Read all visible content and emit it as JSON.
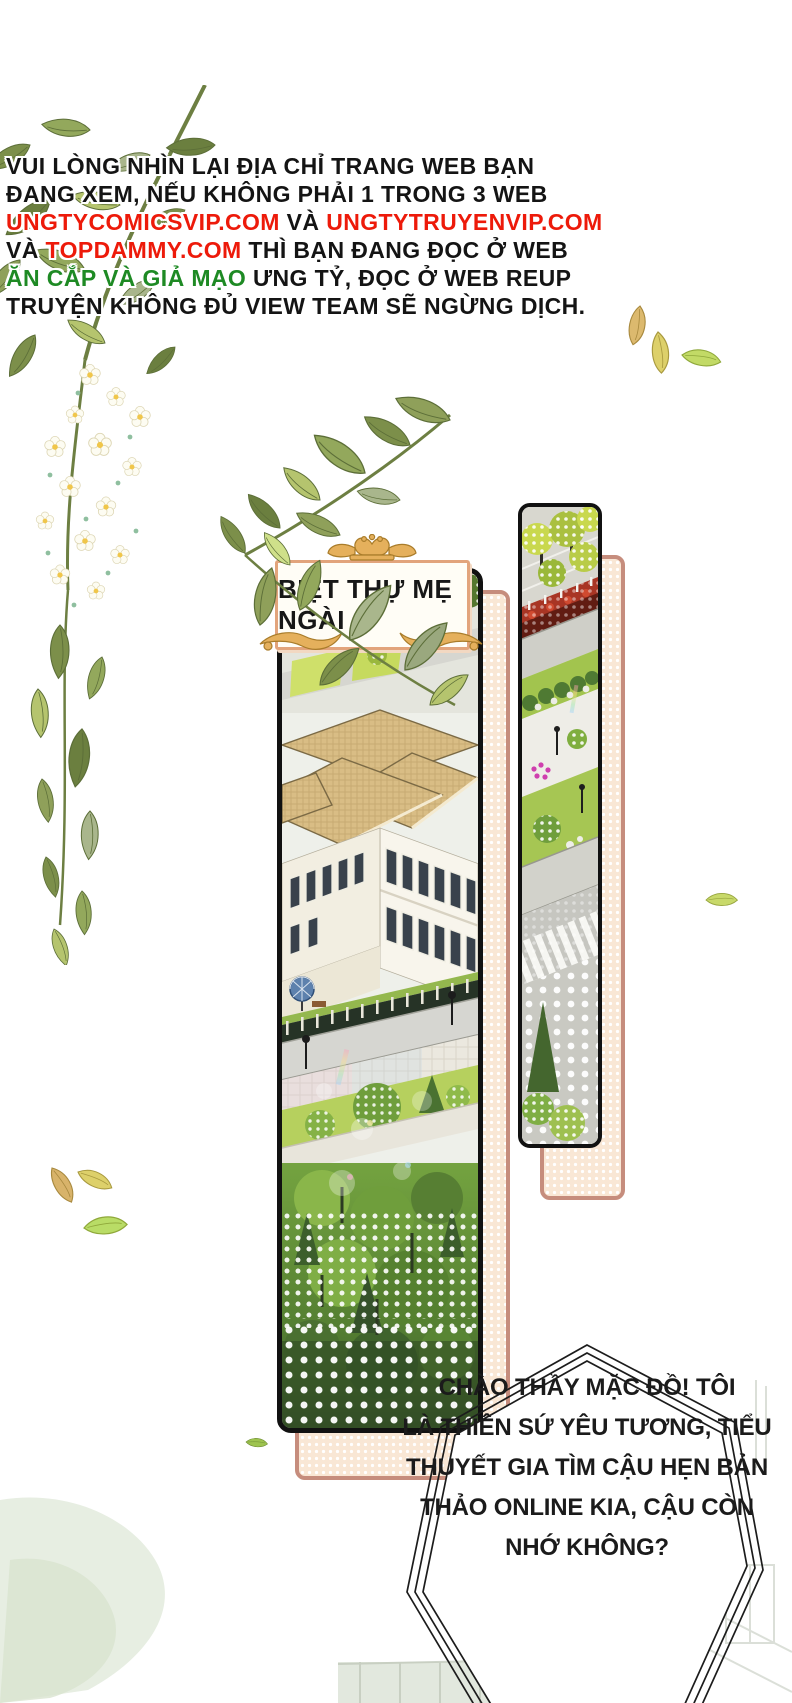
{
  "page": {
    "width": 792,
    "height": 1703,
    "background": "#ffffff"
  },
  "warning": {
    "colors": {
      "black": "#141414",
      "red": "#ed1a0a",
      "green": "#1e8a24"
    },
    "lines": [
      {
        "segments": [
          {
            "color": "black",
            "text": "VUI LÒNG NHÌN LẠI ĐỊA CHỈ TRANG WEB BẠN"
          }
        ]
      },
      {
        "segments": [
          {
            "color": "black",
            "text": "ĐANG XEM, NẾU KHÔNG PHẢI 1 TRONG 3 WEB"
          }
        ]
      },
      {
        "segments": [
          {
            "color": "red",
            "text": "UNGTYCOMICSVIP.COM"
          },
          {
            "color": "black",
            "text": " VÀ "
          },
          {
            "color": "red",
            "text": "UNGTYTRUYENVIP.COM"
          }
        ]
      },
      {
        "segments": [
          {
            "color": "black",
            "text": "VÀ "
          },
          {
            "color": "red",
            "text": "TOPDAMMY.COM"
          },
          {
            "color": "black",
            "text": " THÌ BẠN ĐANG ĐỌC Ở WEB"
          }
        ]
      },
      {
        "segments": [
          {
            "color": "green",
            "text": "ĂN CẮP VÀ GIẢ MẠO"
          },
          {
            "color": "black",
            "text": " ƯNG TỶ, ĐỌC Ở WEB REUP"
          }
        ]
      },
      {
        "segments": [
          {
            "color": "black",
            "text": "TRUYỆN KHÔNG ĐỦ VIEW TEAM SẼ NGỪNG DỊCH."
          }
        ]
      }
    ]
  },
  "location_label": {
    "text": "BIỆT THỰ MẸ NGÀI",
    "frame_color": "#e2a47c",
    "ornament_gold": "#e5b05c"
  },
  "speech_bubble": {
    "lines": [
      "CHÀO THẦY MẶC ĐỒ! TÔI",
      "LÀ THIÊN SỨ YÊU TƯƠNG, TIỂU",
      "THUYẾT GIA TÌM CẬU HẸN BẢN",
      "THẢO ONLINE KIA, CẬU CÒN",
      "NHỚ KHÔNG?"
    ],
    "border_color": "#1c1c1c",
    "fill": "#ffffff"
  },
  "panels": [
    {
      "name": "villa-panel",
      "description": "isometric villa with tan roofs, streets and trees"
    },
    {
      "name": "street-panel",
      "description": "narrow isometric street strip with hedges and crosswalk"
    }
  ],
  "art_colors": {
    "backing_fill": "#f9e7d5",
    "backing_border": "#c68d7d",
    "panel_border": "#111111",
    "roof_tan": "#d9bd85",
    "leaf_olive": "#7c8f4a",
    "leaf_sage": "#a9b68c",
    "leaf_bright": "#b5c46e",
    "flower_petal": "#fdfcf2",
    "flower_center": "#f0c64a",
    "fallen_leaf_tan": "#dcb96e",
    "fallen_leaf_yellow": "#ddd06a",
    "fallen_leaf_green": "#c2da66"
  }
}
